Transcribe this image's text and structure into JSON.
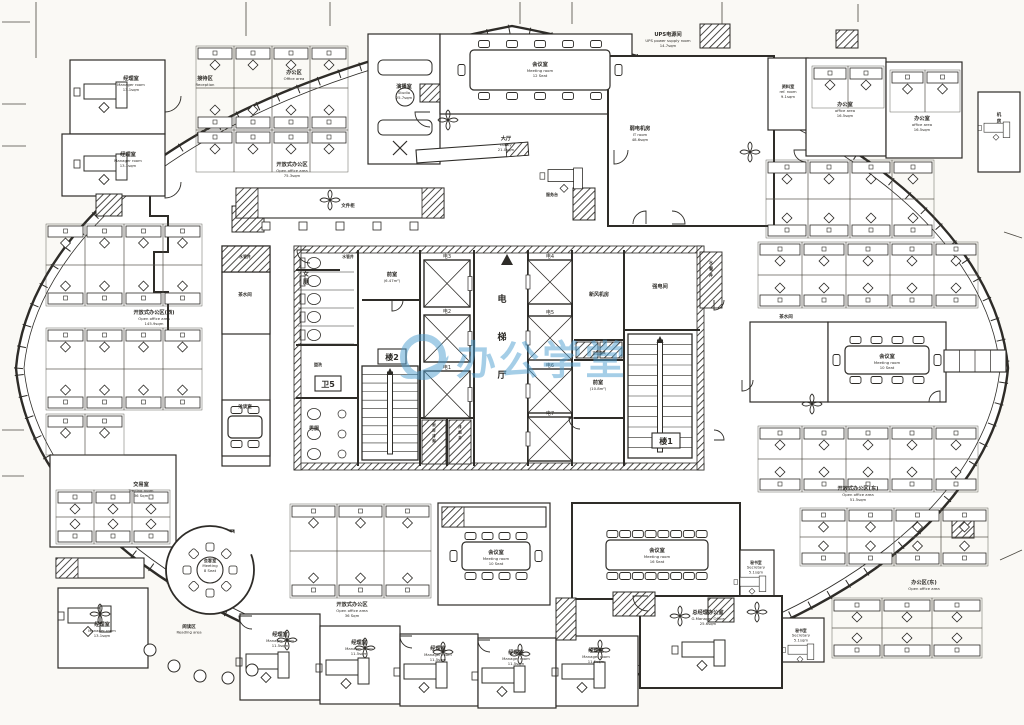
{
  "watermark": {
    "text": "办公学堂",
    "color": "#4d9fd0",
    "logo": "circle-swoosh-icon"
  },
  "canvas": {
    "width": 1024,
    "height": 725,
    "paper": "#faf9f5",
    "ink": "#2e2c28"
  },
  "hull": {
    "outer": "M 16,368 C 26,250 150,96 512,26 C 874,96 998,250 1008,368 C 998,486 874,640 512,702 C 150,640 26,486 16,368 Z",
    "inner": "M 24,368 C 34,257 157,104 512,34 C 867,104 990,257 1000,368 C 990,479 867,632 512,694 C 157,632 34,479 24,368 Z",
    "tick_len": 7,
    "tick_step": 22
  },
  "grid_lines": [
    [
      36,
      2,
      36,
      58
    ],
    [
      2,
      22,
      30,
      22
    ],
    [
      2,
      104,
      26,
      104
    ],
    [
      2,
      146,
      26,
      146
    ],
    [
      246,
      2,
      246,
      36
    ],
    [
      330,
      2,
      330,
      26
    ],
    [
      520,
      2,
      520,
      24
    ],
    [
      572,
      2,
      572,
      24
    ],
    [
      722,
      2,
      722,
      26
    ],
    [
      858,
      4,
      858,
      22
    ],
    [
      2,
      430,
      24,
      430
    ],
    [
      2,
      476,
      24,
      476
    ],
    [
      1004,
      232,
      1022,
      238
    ],
    [
      1000,
      560,
      1022,
      550
    ]
  ],
  "zigzag": [
    [
      96,
      192
    ],
    [
      150,
      192
    ],
    [
      150,
      216
    ],
    [
      168,
      216
    ],
    [
      168,
      252
    ],
    [
      154,
      252
    ],
    [
      154,
      292
    ],
    [
      168,
      292
    ],
    [
      168,
      330
    ]
  ],
  "rooms": [
    {
      "id": "mgr-nw-1",
      "x": 70,
      "y": 60,
      "w": 95,
      "h": 74
    },
    {
      "id": "mgr-nw-2",
      "x": 62,
      "y": 134,
      "w": 103,
      "h": 62
    },
    {
      "id": "studio",
      "x": 368,
      "y": 34,
      "w": 72,
      "h": 130
    },
    {
      "id": "meeting-top",
      "x": 440,
      "y": 34,
      "w": 192,
      "h": 80
    },
    {
      "id": "it-room",
      "x": 608,
      "y": 56,
      "w": 166,
      "h": 170,
      "t": 2
    },
    {
      "id": "ref-room",
      "x": 768,
      "y": 58,
      "w": 40,
      "h": 72
    },
    {
      "id": "office-ne-1",
      "x": 806,
      "y": 58,
      "w": 80,
      "h": 98
    },
    {
      "id": "office-ne-2",
      "x": 886,
      "y": 62,
      "w": 76,
      "h": 96
    },
    {
      "id": "equip-ne",
      "x": 978,
      "y": 92,
      "w": 42,
      "h": 80
    },
    {
      "id": "pantry-e",
      "x": 750,
      "y": 322,
      "w": 78,
      "h": 80
    },
    {
      "id": "meeting-e",
      "x": 828,
      "y": 322,
      "w": 118,
      "h": 80
    },
    {
      "id": "meeting-se",
      "x": 572,
      "y": 503,
      "w": 168,
      "h": 96,
      "t": 2
    },
    {
      "id": "secretary-1",
      "x": 740,
      "y": 550,
      "w": 34,
      "h": 48
    },
    {
      "id": "secretary-2",
      "x": 778,
      "y": 618,
      "w": 46,
      "h": 44
    },
    {
      "id": "gm-office",
      "x": 640,
      "y": 596,
      "w": 142,
      "h": 92,
      "t": 2
    },
    {
      "id": "mgr-b1",
      "x": 240,
      "y": 614,
      "w": 80,
      "h": 86
    },
    {
      "id": "mgr-b2",
      "x": 320,
      "y": 626,
      "w": 80,
      "h": 78
    },
    {
      "id": "mgr-b3",
      "x": 400,
      "y": 634,
      "w": 78,
      "h": 72
    },
    {
      "id": "mgr-b4",
      "x": 478,
      "y": 638,
      "w": 78,
      "h": 70
    },
    {
      "id": "mgr-b5",
      "x": 556,
      "y": 636,
      "w": 82,
      "h": 70
    },
    {
      "id": "mgr-sw",
      "x": 58,
      "y": 588,
      "w": 90,
      "h": 80
    },
    {
      "id": "trading",
      "x": 50,
      "y": 455,
      "w": 126,
      "h": 92
    },
    {
      "id": "meeting-mid",
      "x": 438,
      "y": 503,
      "w": 112,
      "h": 102
    },
    {
      "id": "service-col",
      "x": 222,
      "y": 246,
      "w": 48,
      "h": 220
    },
    {
      "id": "pantry-w",
      "x": 222,
      "y": 272,
      "w": 48,
      "h": 62
    },
    {
      "id": "talk-room",
      "x": 222,
      "y": 400,
      "w": 48,
      "h": 56
    },
    {
      "id": "shaft-w",
      "x": 222,
      "y": 246,
      "w": 48,
      "h": 26,
      "hatch": true
    }
  ],
  "hatch_blocks": [
    [
      232,
      206,
      32,
      26
    ],
    [
      573,
      188,
      22,
      32
    ],
    [
      700,
      24,
      30,
      24
    ],
    [
      96,
      194,
      26,
      22
    ],
    [
      206,
      530,
      28,
      24
    ],
    [
      613,
      592,
      42,
      24
    ],
    [
      708,
      598,
      26,
      24
    ],
    [
      556,
      598,
      20,
      42
    ],
    [
      836,
      30,
      22,
      18
    ],
    [
      952,
      518,
      22,
      20
    ],
    [
      420,
      84,
      20,
      18
    ]
  ],
  "core": {
    "band": [
      294,
      246,
      410,
      224
    ],
    "wall": 7,
    "walls": [
      [
        358,
        250,
        358,
        345
      ],
      [
        296,
        345,
        358,
        345
      ],
      [
        362,
        300,
        420,
        300
      ],
      [
        420,
        250,
        420,
        466
      ],
      [
        474,
        250,
        474,
        466
      ],
      [
        528,
        250,
        528,
        466
      ],
      [
        572,
        250,
        572,
        466
      ],
      [
        624,
        250,
        624,
        330
      ],
      [
        624,
        330,
        700,
        330
      ],
      [
        574,
        340,
        624,
        340
      ],
      [
        574,
        360,
        624,
        360
      ],
      [
        574,
        418,
        624,
        418
      ],
      [
        624,
        330,
        624,
        466
      ],
      [
        296,
        398,
        358,
        398
      ],
      [
        358,
        345,
        358,
        466
      ],
      [
        420,
        418,
        474,
        418
      ],
      [
        447,
        418,
        447,
        466
      ],
      [
        296,
        270,
        340,
        270
      ]
    ],
    "elevators": {
      "left": {
        "x": 424,
        "w": 46,
        "ys": [
          260,
          315,
          371
        ],
        "h": 47,
        "labels": [
          "电3",
          "电2",
          "电1"
        ]
      },
      "right": {
        "x": 528,
        "w": 44,
        "ys": [
          260,
          316,
          369,
          417
        ],
        "h": 44,
        "labels": [
          "电4",
          "电5",
          "电6",
          "电7"
        ]
      }
    },
    "stairs": [
      {
        "x": 362,
        "y": 366,
        "w": 56,
        "h": 94,
        "treads": 11,
        "label": "楼2"
      },
      {
        "x": 628,
        "y": 334,
        "w": 64,
        "h": 124,
        "treads": 12,
        "label": "楼1"
      }
    ],
    "shafts": [
      {
        "x": 422,
        "y": 420,
        "w": 24,
        "h": 44
      },
      {
        "x": 449,
        "y": 420,
        "w": 22,
        "h": 44
      },
      {
        "x": 576,
        "y": 342,
        "w": 22,
        "h": 16
      },
      {
        "x": 600,
        "y": 342,
        "w": 22,
        "h": 16
      },
      {
        "x": 700,
        "y": 252,
        "w": 22,
        "h": 56
      }
    ],
    "wc": {
      "women": {
        "x": 298,
        "y": 254,
        "stalls": 5
      },
      "men": {
        "x": 298,
        "y": 402,
        "stalls": 3
      }
    },
    "entrance_triangle": [
      507,
      254
    ]
  },
  "boxed_labels": [
    {
      "text": "卫5",
      "x": 315,
      "y": 376,
      "w": 26,
      "h": 15,
      "s": 8
    },
    {
      "text": "楼2",
      "x": 378,
      "y": 349,
      "w": 28,
      "h": 15,
      "s": 8
    },
    {
      "text": "楼1",
      "x": 652,
      "y": 433,
      "w": 28,
      "h": 15,
      "s": 8
    }
  ],
  "labels": [
    {
      "cn": "经理室",
      "en": "Manager room",
      "area": "13.1sqm",
      "x": 131,
      "y": 80
    },
    {
      "cn": "经理室",
      "en": "Manager room",
      "area": "13.1sqm",
      "x": 128,
      "y": 156
    },
    {
      "cn": "接待区",
      "en": "Reception",
      "area": "",
      "x": 205,
      "y": 80
    },
    {
      "cn": "办公区",
      "en": "Office area",
      "area": "",
      "x": 294,
      "y": 74
    },
    {
      "cn": "开放式办公区",
      "en": "Open office area",
      "area": "75.3sqm",
      "x": 292,
      "y": 166
    },
    {
      "cn": "文件柜",
      "en": "",
      "area": "",
      "x": 348,
      "y": 207,
      "s": 4.5
    },
    {
      "cn": "演播室",
      "en": "Studio",
      "area": "25.7sqm",
      "x": 404,
      "y": 88
    },
    {
      "cn": "会议室",
      "en": "Meeting room",
      "area": "12 Seat",
      "x": 540,
      "y": 66
    },
    {
      "cn": "大厅",
      "en": "Lobby",
      "area": "21.0sqm",
      "x": 506,
      "y": 140
    },
    {
      "cn": "服务台",
      "en": "",
      "area": "",
      "x": 552,
      "y": 196,
      "s": 4
    },
    {
      "cn": "UPS电源间",
      "en": "UPS power supply room",
      "area": "14.7sqm",
      "x": 668,
      "y": 36
    },
    {
      "cn": "弱电机房",
      "en": "IT room",
      "area": "48.6sqm",
      "x": 640,
      "y": 130
    },
    {
      "cn": "资料室",
      "en": "ref. room",
      "area": "9.1sqm",
      "x": 788,
      "y": 88,
      "s": 4.2
    },
    {
      "cn": "办公室",
      "en": "office area",
      "area": "16.5sqm",
      "x": 845,
      "y": 106
    },
    {
      "cn": "办公室",
      "en": "office area",
      "area": "16.5sqm",
      "x": 922,
      "y": 120
    },
    {
      "cn": "开放式办公区(东)",
      "en": "Open office area",
      "area": "51.5sqm",
      "x": 858,
      "y": 490
    },
    {
      "cn": "办公区(东)",
      "en": "Open office area",
      "area": "",
      "x": 924,
      "y": 584
    },
    {
      "cn": "茶水间",
      "en": "",
      "area": "",
      "x": 786,
      "y": 318,
      "s": 4.5
    },
    {
      "cn": "会议室",
      "en": "Meeting room",
      "area": "10 Seat",
      "x": 887,
      "y": 358
    },
    {
      "cn": "会议室",
      "en": "Meeting room",
      "area": "16 Seat",
      "x": 657,
      "y": 552
    },
    {
      "cn": "会议室",
      "en": "Meeting room",
      "area": "10 Seat",
      "x": 496,
      "y": 554
    },
    {
      "cn": "秘书室",
      "en": "Secretary",
      "area": "5.1sqm",
      "x": 756,
      "y": 564,
      "s": 3.8
    },
    {
      "cn": "秘书室",
      "en": "Secretary",
      "area": "5.1sqm",
      "x": 801,
      "y": 632,
      "s": 3.8
    },
    {
      "cn": "总经理办公室",
      "en": "G.Manager Office",
      "area": "25.6sqm",
      "x": 708,
      "y": 614
    },
    {
      "cn": "经理室",
      "en": "Manager room",
      "area": "11.5sqm",
      "x": 280,
      "y": 636
    },
    {
      "cn": "经理室",
      "en": "Manager room",
      "area": "11.5sqm",
      "x": 359,
      "y": 644
    },
    {
      "cn": "经理室",
      "en": "Manager room",
      "area": "11.5sqm",
      "x": 438,
      "y": 650
    },
    {
      "cn": "经理室",
      "en": "Manager room",
      "area": "11.5sqm",
      "x": 516,
      "y": 654
    },
    {
      "cn": "经理室",
      "en": "Manager room",
      "area": "11.5sqm",
      "x": 596,
      "y": 652
    },
    {
      "cn": "经理室",
      "en": "Manager room",
      "area": "13.1sqm",
      "x": 102,
      "y": 626
    },
    {
      "cn": "交易室",
      "en": "Trading room",
      "area": "36 Sqm",
      "x": 141,
      "y": 486
    },
    {
      "cn": "会客室",
      "en": "Meeting",
      "area": "8 Seat",
      "x": 210,
      "y": 562,
      "s": 4.2
    },
    {
      "cn": "阅读区",
      "en": "Reading area",
      "area": "",
      "x": 189,
      "y": 628,
      "s": 4.5
    },
    {
      "cn": "开放式办公区",
      "en": "Open office area",
      "area": "36 Sqm",
      "x": 352,
      "y": 606
    },
    {
      "cn": "开放式办公区(西)",
      "en": "Open office area",
      "area": "145.9sqm",
      "x": 154,
      "y": 314
    },
    {
      "cn": "洽谈室",
      "en": "",
      "area": "",
      "x": 245,
      "y": 408,
      "s": 4.5
    },
    {
      "cn": "茶水间",
      "en": "",
      "area": "",
      "x": 245,
      "y": 296,
      "s": 4.5
    },
    {
      "cn": "水管井",
      "en": "",
      "area": "",
      "x": 245,
      "y": 258,
      "s": 3.8
    },
    {
      "cn": "水管井",
      "en": "",
      "area": "",
      "x": 348,
      "y": 258,
      "s": 3.8
    },
    {
      "cn": "前室",
      "en": "(6.47m²)",
      "area": "",
      "x": 392,
      "y": 276
    },
    {
      "cn": "前室",
      "en": "(10.8m²)",
      "area": "",
      "x": 598,
      "y": 384
    },
    {
      "cn": "新风机房",
      "en": "",
      "area": "",
      "x": 599,
      "y": 296,
      "s": 5
    },
    {
      "cn": "强电间",
      "en": "",
      "area": "",
      "x": 660,
      "y": 288
    },
    {
      "cn": "盥洗",
      "en": "",
      "area": "",
      "x": 318,
      "y": 366,
      "s": 4
    },
    {
      "cn": "男厕",
      "en": "",
      "area": "",
      "x": 314,
      "y": 430,
      "s": 5
    },
    {
      "cn": "正压送风",
      "en": "",
      "area": "",
      "x": 599,
      "y": 354,
      "s": 3.3
    },
    {
      "cn": "女厕",
      "vert": true,
      "x": 306,
      "y": 276,
      "s": 6
    },
    {
      "cn": "电梯厅",
      "vert": true,
      "x": 502,
      "y": 302,
      "s": 9,
      "dy": 38
    },
    {
      "cn": "水管井",
      "vert": true,
      "x": 711,
      "y": 264,
      "s": 4.2
    },
    {
      "cn": "机房",
      "vert": true,
      "x": 999,
      "y": 116,
      "s": 4.5
    },
    {
      "cn": "排烟井",
      "vert": true,
      "x": 460,
      "y": 428,
      "s": 3.4
    },
    {
      "cn": "厨房排烟",
      "vert": true,
      "x": 434,
      "y": 426,
      "s": 3.4
    }
  ],
  "desk_clusters": [
    {
      "x": 196,
      "y": 46,
      "cols": 4,
      "rows": 3,
      "cw": 38,
      "ch": 42
    },
    {
      "x": 46,
      "y": 224,
      "cols": 4,
      "rows": 2,
      "cw": 39,
      "ch": 41
    },
    {
      "x": 46,
      "y": 328,
      "cols": 4,
      "rows": 2,
      "cw": 39,
      "ch": 41
    },
    {
      "x": 46,
      "y": 414,
      "cols": 2,
      "rows": 1,
      "cw": 39,
      "ch": 41
    },
    {
      "x": 56,
      "y": 490,
      "cols": 3,
      "rows": 2,
      "cw": 38,
      "ch": 27
    },
    {
      "x": 290,
      "y": 504,
      "cols": 3,
      "rows": 2,
      "cw": 47,
      "ch": 47
    },
    {
      "x": 758,
      "y": 242,
      "cols": 5,
      "rows": 2,
      "cw": 44,
      "ch": 33
    },
    {
      "x": 758,
      "y": 426,
      "cols": 5,
      "rows": 2,
      "cw": 44,
      "ch": 33
    },
    {
      "x": 800,
      "y": 508,
      "cols": 4,
      "rows": 2,
      "cw": 47,
      "ch": 29
    },
    {
      "x": 832,
      "y": 598,
      "cols": 3,
      "rows": 2,
      "cw": 50,
      "ch": 30
    },
    {
      "x": 766,
      "y": 160,
      "cols": 4,
      "rows": 2,
      "cw": 42,
      "ch": 39
    },
    {
      "x": 812,
      "y": 66,
      "cols": 2,
      "rows": 1,
      "cw": 36,
      "ch": 42
    },
    {
      "x": 890,
      "y": 70,
      "cols": 2,
      "rows": 1,
      "cw": 35,
      "ch": 42
    }
  ],
  "exec_desks": [
    {
      "x": 104,
      "y": 92
    },
    {
      "x": 104,
      "y": 164
    },
    {
      "x": 88,
      "y": 616
    },
    {
      "x": 266,
      "y": 662
    },
    {
      "x": 346,
      "y": 668
    },
    {
      "x": 424,
      "y": 672
    },
    {
      "x": 502,
      "y": 676
    },
    {
      "x": 582,
      "y": 672
    },
    {
      "x": 702,
      "y": 650
    },
    {
      "x": 752,
      "y": 582,
      "s": 0.6
    },
    {
      "x": 800,
      "y": 650,
      "s": 0.6
    },
    {
      "x": 996,
      "y": 128,
      "s": 0.6
    },
    {
      "x": 564,
      "y": 176,
      "s": 0.8
    }
  ],
  "tables": [
    {
      "x": 470,
      "y": 50,
      "w": 140,
      "h": 40,
      "top": 5,
      "bottom": 5,
      "left": 1,
      "right": 1
    },
    {
      "x": 845,
      "y": 346,
      "w": 84,
      "h": 28,
      "top": 4,
      "bottom": 4,
      "left": 1,
      "right": 1
    },
    {
      "x": 606,
      "y": 540,
      "w": 102,
      "h": 30,
      "top": 8,
      "bottom": 8,
      "left": 0,
      "right": 0
    },
    {
      "x": 462,
      "y": 542,
      "w": 68,
      "h": 28,
      "top": 4,
      "bottom": 4,
      "left": 1,
      "right": 1
    },
    {
      "x": 228,
      "y": 416,
      "w": 34,
      "h": 22,
      "top": 2,
      "bottom": 2,
      "left": 0,
      "right": 0
    }
  ],
  "round_room": {
    "cx": 210,
    "cy": 570,
    "r_wall": 44,
    "r_table": 13,
    "chairs": 8
  },
  "studio_furniture": {
    "sofas": [
      [
        378,
        60,
        54,
        15
      ],
      [
        378,
        120,
        54,
        15
      ]
    ],
    "table": [
      405,
      97,
      9
    ],
    "tripod": [
      400,
      148
    ]
  },
  "counters": [
    {
      "x": 236,
      "y": 188,
      "w": 208,
      "h": 30,
      "hatch": "both",
      "stools": 5
    },
    {
      "x": 56,
      "y": 558,
      "w": 88,
      "h": 20,
      "hatch": "left",
      "stools": 0
    },
    {
      "x": 442,
      "y": 507,
      "w": 104,
      "h": 20,
      "hatch": "left",
      "stools": 0
    },
    {
      "x": 944,
      "y": 350,
      "w": 62,
      "h": 22,
      "dividers": 3
    },
    {
      "x": 416,
      "y": 150,
      "w": 112,
      "h": 13,
      "rot": -4,
      "hatch": "right"
    }
  ],
  "lounge_seats": [
    [
      150,
      650
    ],
    [
      174,
      666
    ],
    [
      200,
      676
    ],
    [
      228,
      678
    ],
    [
      252,
      670
    ]
  ],
  "fans": [
    [
      287,
      640
    ],
    [
      365,
      648
    ],
    [
      443,
      652
    ],
    [
      520,
      654
    ],
    [
      600,
      650
    ],
    [
      680,
      616
    ],
    [
      100,
      614
    ],
    [
      448,
      120
    ],
    [
      330,
      200
    ],
    [
      750,
      152
    ],
    [
      757,
      612
    ],
    [
      812,
      404
    ]
  ],
  "door_arcs": [
    {
      "x": 165,
      "y": 96,
      "r": 16,
      "dir": 0
    },
    {
      "x": 165,
      "y": 182,
      "r": 16,
      "dir": 0
    },
    {
      "x": 430,
      "y": 112,
      "r": 15,
      "dir": 1
    },
    {
      "x": 646,
      "y": 224,
      "r": 13,
      "dir": 2
    },
    {
      "x": 672,
      "y": 224,
      "r": 13,
      "dir": 3
    },
    {
      "x": 614,
      "y": 150,
      "r": 14,
      "dir": 0
    },
    {
      "x": 806,
      "y": 150,
      "r": 12,
      "dir": 1
    },
    {
      "x": 310,
      "y": 250,
      "r": 13,
      "dir": 1
    },
    {
      "x": 392,
      "y": 300,
      "r": 11,
      "dir": 0
    },
    {
      "x": 580,
      "y": 418,
      "r": 11,
      "dir": 1
    },
    {
      "x": 648,
      "y": 596,
      "r": 15,
      "dir": 1
    },
    {
      "x": 252,
      "y": 616,
      "r": 13,
      "dir": 1
    },
    {
      "x": 412,
      "y": 636,
      "r": 12,
      "dir": 1
    },
    {
      "x": 490,
      "y": 640,
      "r": 12,
      "dir": 1
    },
    {
      "x": 742,
      "y": 380,
      "r": 11,
      "dir": 0
    },
    {
      "x": 940,
      "y": 402,
      "r": 11,
      "dir": 2
    },
    {
      "x": 714,
      "y": 300,
      "r": 10,
      "dir": 0
    },
    {
      "x": 714,
      "y": 440,
      "r": 10,
      "dir": 3
    }
  ]
}
